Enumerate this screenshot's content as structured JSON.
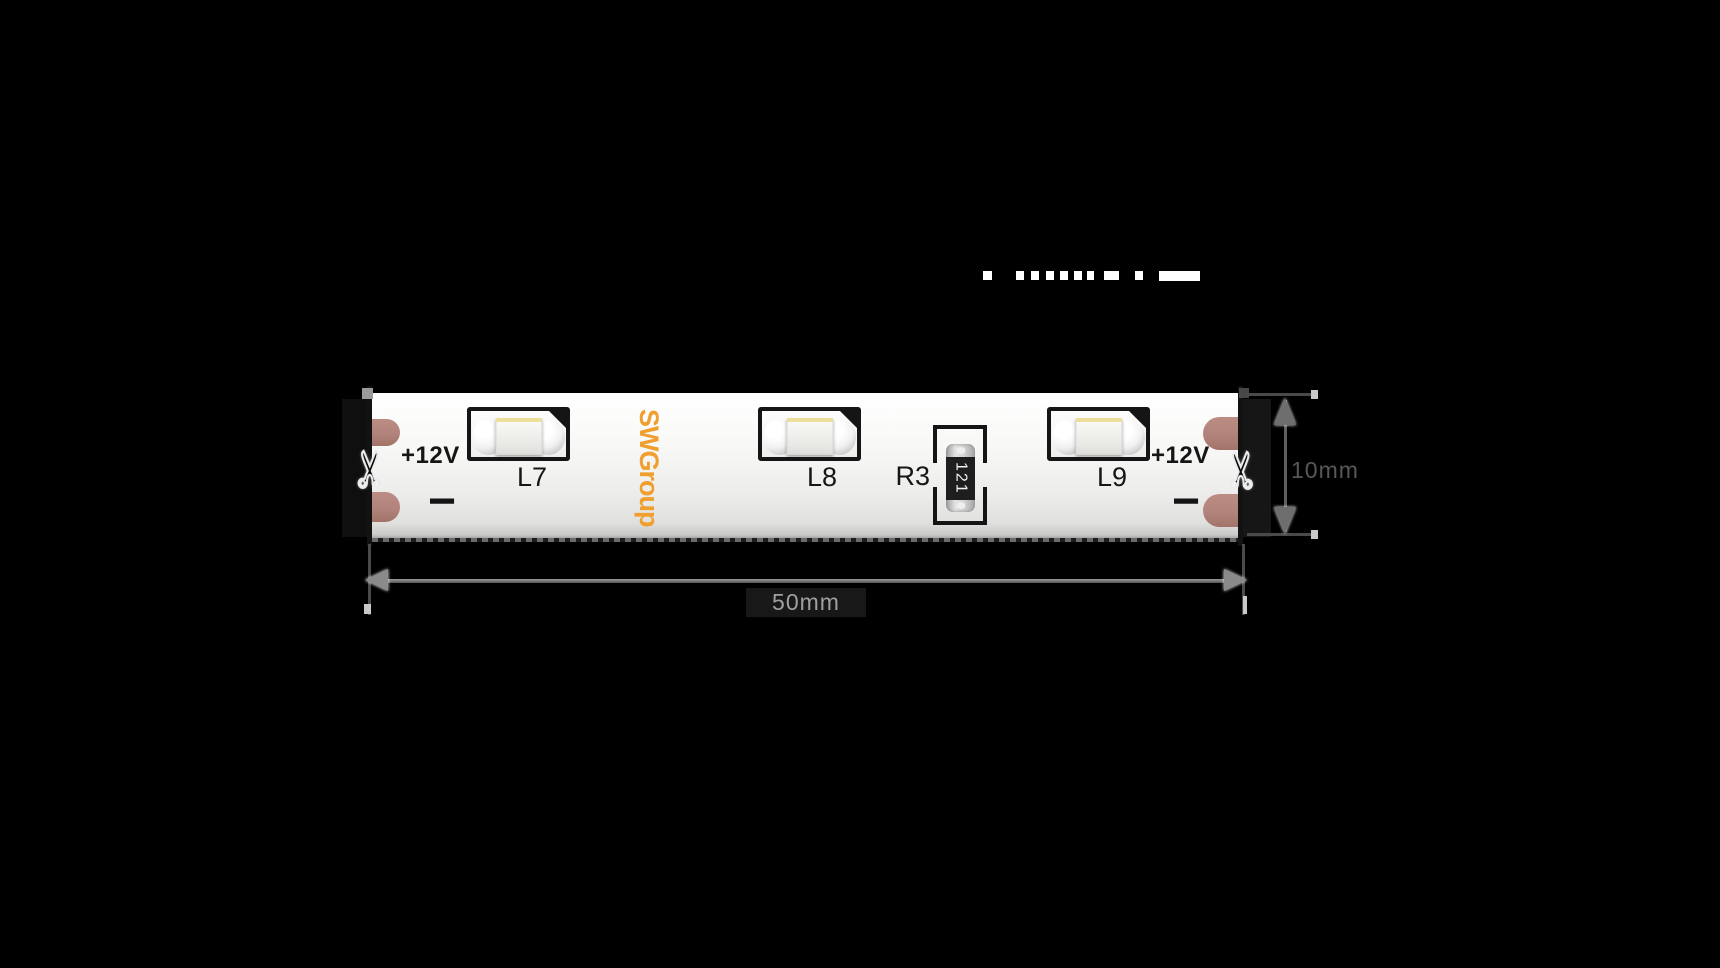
{
  "diagram": {
    "brand_logo": "SWGroup",
    "leds": [
      {
        "label": "L7"
      },
      {
        "label": "L8"
      },
      {
        "label": "L9"
      }
    ],
    "resistor": {
      "label": "R3",
      "value": "121"
    },
    "polarity": {
      "left_positive": "+12V",
      "right_positive": "+12V",
      "left_negative": "−",
      "right_negative": "−"
    },
    "dimensions": {
      "width_label": "50mm",
      "height_label": "10mm"
    },
    "icons": {
      "scissors_glyph": "✂"
    },
    "colors": {
      "background": "#000000",
      "strip_white": "#f4f4f2",
      "logo_orange": "#f09e2e",
      "copper_pad": "#b2837b",
      "component_outline": "#151515",
      "led_chip_yellow": "#ecdf9c",
      "dimension_gray": "#8f8f8f"
    }
  }
}
